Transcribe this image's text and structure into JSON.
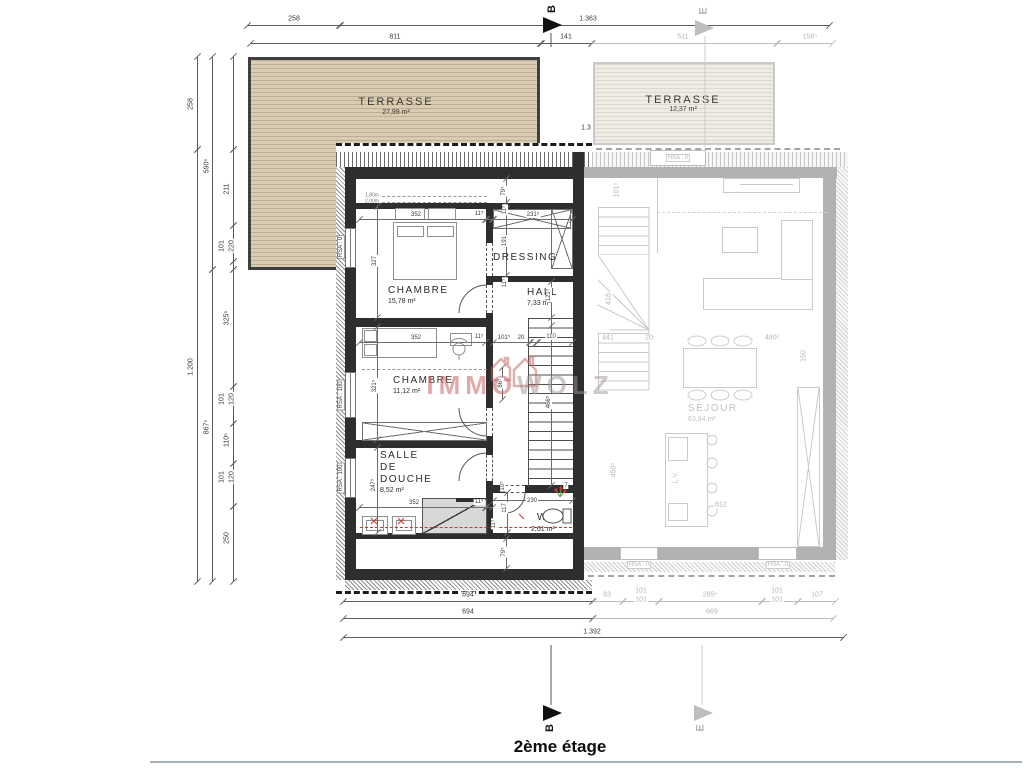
{
  "title": "2ème étage",
  "watermark": {
    "part1": "IMMO",
    "part2": "WOLZ"
  },
  "sections": {
    "b": "B",
    "e": "E"
  },
  "main_unit": {
    "rooms": {
      "terrasse": {
        "name": "TERRASSE",
        "area": "27,99 m²"
      },
      "chambre1": {
        "name": "CHAMBRE",
        "area": "15,78 m²"
      },
      "dressing": {
        "name": "DRESSING"
      },
      "hall": {
        "name": "HALL",
        "area": "7,33 m²"
      },
      "chambre2": {
        "name": "CHAMBRE",
        "area": "11,12 m²"
      },
      "sdd_l1": "SALLE",
      "sdd_l2": "DE",
      "sdd_l3": "DOUCHE",
      "sdd_area": "8,52 m²",
      "wc": {
        "name": "WC",
        "area": "2,61 m²"
      }
    },
    "window_labels": [
      "RSA : 0",
      "RSA : 100",
      "RSA : 100"
    ],
    "ceiling_marks": [
      "1,80m",
      "2,00m"
    ]
  },
  "adjacent_unit": {
    "rooms": {
      "terrasse": {
        "name": "TERRASSE",
        "area": "12,37 m²"
      },
      "sejour": {
        "name": "SÉJOUR",
        "area": "63,84 m²"
      }
    },
    "window_labels": [
      "HSA : 0",
      "HSA : 0",
      "HSA : 0"
    ],
    "island_label": "L.V."
  },
  "dimension_labels": [
    {
      "t": "258",
      "x": 294,
      "y": 19
    },
    {
      "t": "1.363",
      "x": 588,
      "y": 19
    },
    {
      "t": "811",
      "x": 395,
      "y": 37
    },
    {
      "t": "141",
      "x": 566,
      "y": 37
    },
    {
      "t": "511",
      "x": 683,
      "y": 37,
      "c": "g"
    },
    {
      "t": "158⁵",
      "x": 810,
      "y": 37,
      "c": "g"
    },
    {
      "t": "1.3",
      "x": 586,
      "y": 128
    },
    {
      "t": "258",
      "x": 191,
      "y": 104,
      "r": 1
    },
    {
      "t": "1.200",
      "x": 191,
      "y": 367,
      "r": 1
    },
    {
      "t": "590⁵",
      "x": 207,
      "y": 166,
      "r": 1
    },
    {
      "t": "867⁵",
      "x": 207,
      "y": 427,
      "r": 1
    },
    {
      "t": "211",
      "x": 227,
      "y": 189,
      "r": 1
    },
    {
      "t": "101",
      "x": 222,
      "y": 246,
      "r": 1
    },
    {
      "t": "220",
      "x": 232,
      "y": 246,
      "r": 1
    },
    {
      "t": "325⁵",
      "x": 227,
      "y": 318,
      "r": 1
    },
    {
      "t": "101",
      "x": 222,
      "y": 399,
      "r": 1
    },
    {
      "t": "120",
      "x": 232,
      "y": 399,
      "r": 1
    },
    {
      "t": "110⁵",
      "x": 227,
      "y": 440,
      "r": 1
    },
    {
      "t": "101",
      "x": 222,
      "y": 477,
      "r": 1
    },
    {
      "t": "120",
      "x": 232,
      "y": 477,
      "r": 1
    },
    {
      "t": "250",
      "x": 227,
      "y": 538,
      "r": 1
    },
    {
      "t": "694",
      "x": 468,
      "y": 595
    },
    {
      "t": "83",
      "x": 607,
      "y": 595,
      "c": "g"
    },
    {
      "t": "101",
      "x": 641,
      "y": 591,
      "c": "g"
    },
    {
      "t": "101",
      "x": 641,
      "y": 600,
      "c": "g"
    },
    {
      "t": "285⁵",
      "x": 710,
      "y": 595,
      "c": "g"
    },
    {
      "t": "101",
      "x": 777,
      "y": 591,
      "c": "g"
    },
    {
      "t": "101",
      "x": 777,
      "y": 600,
      "c": "g"
    },
    {
      "t": "107",
      "x": 817,
      "y": 595,
      "c": "g"
    },
    {
      "t": "694",
      "x": 468,
      "y": 612
    },
    {
      "t": "669",
      "x": 712,
      "y": 612,
      "c": "g"
    },
    {
      "t": "1.392",
      "x": 592,
      "y": 632
    },
    {
      "t": "79⁵",
      "x": 504,
      "y": 191,
      "r": 1,
      "c": "s"
    },
    {
      "t": "352",
      "x": 416,
      "y": 215,
      "c": "s"
    },
    {
      "t": "11⁵",
      "x": 479,
      "y": 214,
      "c": "s"
    },
    {
      "t": "11⁵",
      "x": 505,
      "y": 210,
      "r": 1,
      "c": "s"
    },
    {
      "t": "231⁵",
      "x": 533,
      "y": 215,
      "c": "s"
    },
    {
      "t": "327",
      "x": 375,
      "y": 261,
      "r": 1,
      "c": "s"
    },
    {
      "t": "191",
      "x": 505,
      "y": 241,
      "r": 1,
      "c": "s"
    },
    {
      "t": "11⁵",
      "x": 505,
      "y": 283,
      "r": 1,
      "c": "s"
    },
    {
      "t": "121⁵",
      "x": 549,
      "y": 295,
      "r": 1,
      "c": "s"
    },
    {
      "t": "352",
      "x": 416,
      "y": 338,
      "c": "s"
    },
    {
      "t": "11⁵",
      "x": 479,
      "y": 337,
      "c": "s"
    },
    {
      "t": "101⁵",
      "x": 504,
      "y": 338,
      "c": "s"
    },
    {
      "t": "20",
      "x": 521,
      "y": 338,
      "c": "s"
    },
    {
      "t": "110",
      "x": 551,
      "y": 337,
      "c": "s"
    },
    {
      "t": "321⁵",
      "x": 375,
      "y": 386,
      "r": 1,
      "c": "s"
    },
    {
      "t": "86⁵",
      "x": 501,
      "y": 383,
      "r": 1,
      "c": "s"
    },
    {
      "t": "466⁵",
      "x": 549,
      "y": 402,
      "r": 1,
      "c": "s"
    },
    {
      "t": "247⁵",
      "x": 374,
      "y": 485,
      "r": 1,
      "c": "s"
    },
    {
      "t": "352",
      "x": 414,
      "y": 503,
      "c": "s"
    },
    {
      "t": "11⁵",
      "x": 479,
      "y": 502,
      "c": "s"
    },
    {
      "t": "117",
      "x": 505,
      "y": 508,
      "r": 1,
      "c": "s"
    },
    {
      "t": "10⁵",
      "x": 503,
      "y": 486,
      "r": 1,
      "c": "s"
    },
    {
      "t": "230",
      "x": 532,
      "y": 501,
      "c": "s"
    },
    {
      "t": "11⁵",
      "x": 494,
      "y": 524,
      "r": 1,
      "c": "s"
    },
    {
      "t": "7",
      "x": 566,
      "y": 486,
      "c": "s"
    },
    {
      "t": "79⁵",
      "x": 504,
      "y": 552,
      "r": 1,
      "c": "s"
    },
    {
      "t": "1,80m",
      "x": 372,
      "y": 196,
      "c": "t"
    },
    {
      "t": "2,00m",
      "x": 372,
      "y": 202,
      "c": "t"
    },
    {
      "t": "RSA : 0",
      "x": 341,
      "y": 247,
      "r": 1,
      "c": "wl"
    },
    {
      "t": "RSA : 100",
      "x": 341,
      "y": 395,
      "r": 1,
      "c": "wl"
    },
    {
      "t": "RSA : 100",
      "x": 341,
      "y": 478,
      "r": 1,
      "c": "wl"
    },
    {
      "t": "HSA : 0",
      "x": 678,
      "y": 158,
      "c": "wlg"
    },
    {
      "t": "HSA : 0",
      "x": 639,
      "y": 565,
      "c": "wlg"
    },
    {
      "t": "HSA : 0",
      "x": 778,
      "y": 565,
      "c": "wlg"
    },
    {
      "t": "101⁵",
      "x": 617,
      "y": 190,
      "r": 1,
      "c": "g"
    },
    {
      "t": "418",
      "x": 609,
      "y": 299,
      "r": 1,
      "c": "g"
    },
    {
      "t": "441",
      "x": 608,
      "y": 338,
      "c": "g"
    },
    {
      "t": "20",
      "x": 649,
      "y": 338,
      "c": "g"
    },
    {
      "t": "480²",
      "x": 772,
      "y": 338,
      "c": "g"
    },
    {
      "t": "150",
      "x": 804,
      "y": 356,
      "r": 1,
      "c": "g"
    },
    {
      "t": "450⁵",
      "x": 614,
      "y": 470,
      "r": 1,
      "c": "g"
    },
    {
      "t": "612",
      "x": 721,
      "y": 505,
      "c": "g"
    }
  ]
}
